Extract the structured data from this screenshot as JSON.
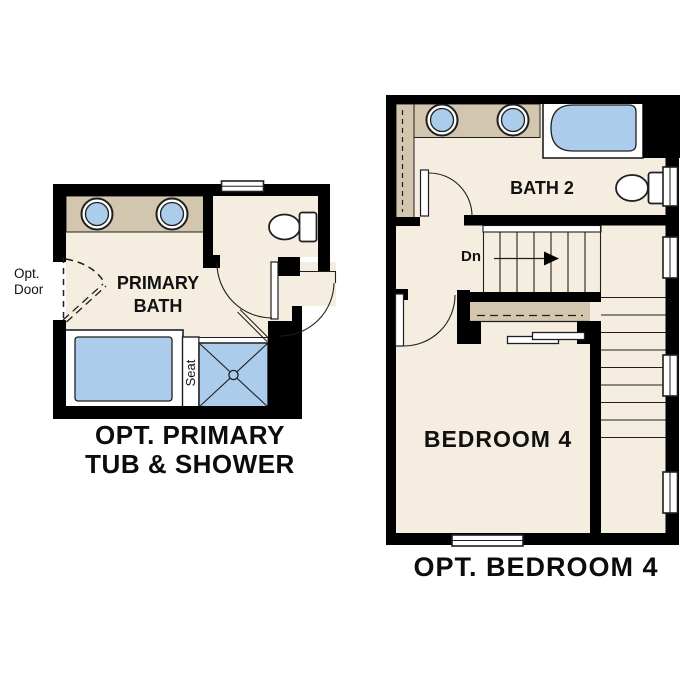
{
  "colors": {
    "wall": "#000000",
    "floor": "#f5eee0",
    "counter": "#d2c7ae",
    "fixture": "#abccea",
    "line": "#1f1f1f",
    "label": "#111111"
  },
  "left_plan": {
    "opt_door_label": "Opt. Door",
    "room_label": "PRIMARY BATH",
    "seat_label": "Seat",
    "caption_line1": "OPT. PRIMARY",
    "caption_line2": "TUB & SHOWER",
    "fixture_icons": [
      "double-sink-vanity",
      "toilet",
      "window",
      "tub",
      "shower",
      "optional-door"
    ]
  },
  "right_plan": {
    "bath_label": "BATH 2",
    "stairs_label": "Dn",
    "bedroom_label": "BEDROOM 4",
    "caption": "OPT. BEDROOM 4",
    "fixture_icons": [
      "double-sink-vanity",
      "tub",
      "toilet",
      "stairs-down",
      "closet-bypass-doors",
      "windows"
    ]
  }
}
